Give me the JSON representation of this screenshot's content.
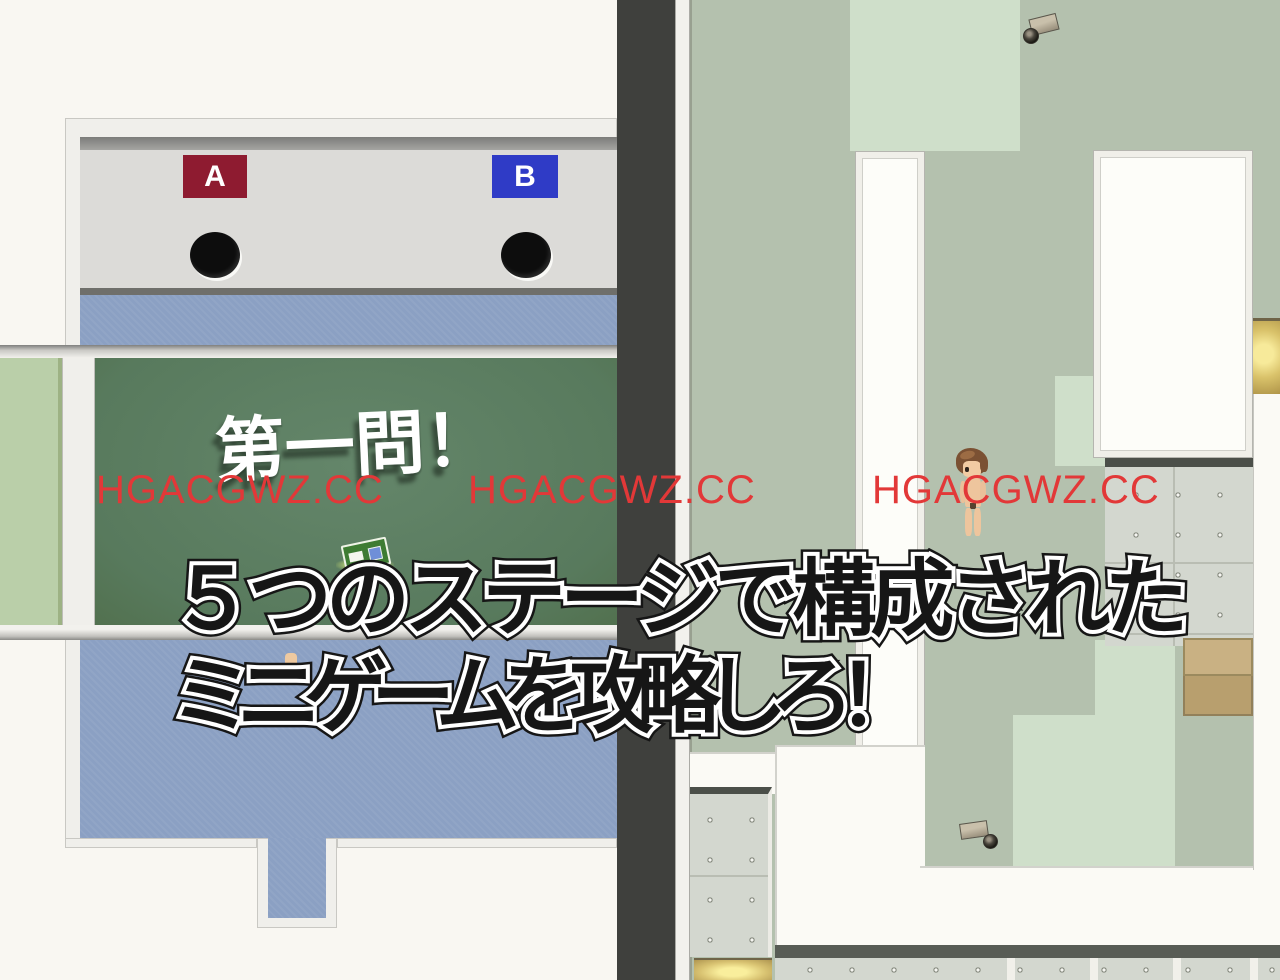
{
  "scene": {
    "description": "Split-screen RPG game screenshot: quiz room with A/B buzzer desks on the left, top-down facility map with security cameras on the right",
    "caption_line1": "５つのステージで構成された",
    "caption_line2": "ミニゲームを攻略しろ！"
  },
  "quiz_room": {
    "choice_a": "A",
    "choice_b": "B",
    "board_text": "第一問！"
  },
  "watermark": {
    "text": "HGACGWZ.CC",
    "color": "#e23838",
    "count": 3
  },
  "map": {
    "icons": {
      "camera_top": "security-camera",
      "camera_bottom": "security-camera",
      "player": "player-character-sprite",
      "item_sign": "card-sign-pickup"
    }
  },
  "colors": {
    "background": "#f9f7f2",
    "divider": "#3f403d",
    "wall_gray": "#dcdbd8",
    "choice_a_bg": "#8e1b30",
    "choice_b_bg": "#2f3bc6",
    "carpet_blue": "#8ba0c3",
    "board_green": "#5d7e60",
    "grass_green": "#bacfa9",
    "floor_sage": "#b4c1ae",
    "floor_light": "#cfdfca",
    "concrete": "#d3d7cf",
    "cabinet_tan": "#c9b183",
    "locker_gold": "#e8d173",
    "watermark_red": "#e23838",
    "caption_fill": "#161616",
    "caption_outline": "#ffffff"
  }
}
